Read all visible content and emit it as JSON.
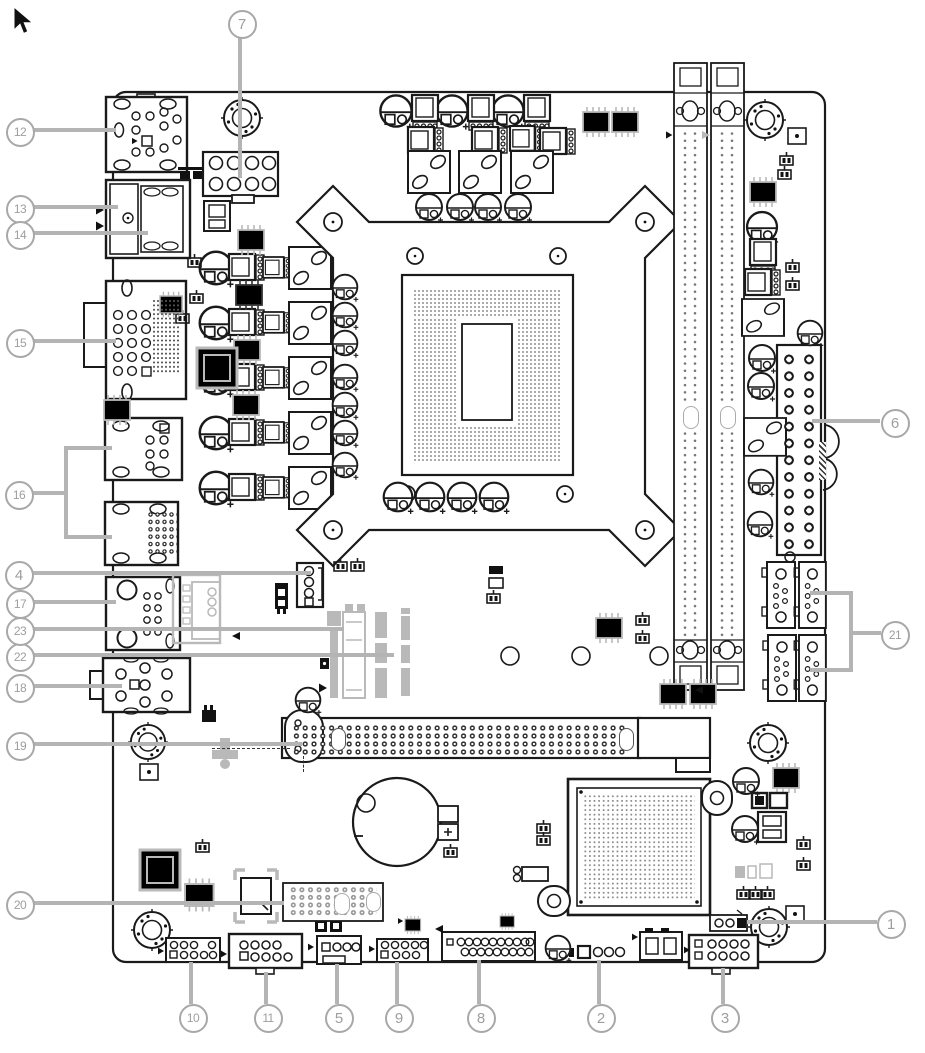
{
  "figure": {
    "kind": "motherboard-layout-diagram",
    "palette": {
      "ink": "#1a1a1a",
      "gray_parts": "#b9b9b9",
      "leader_line": "#b4b4b4",
      "callout": "#a8a8a8"
    }
  },
  "callouts": [
    {
      "label": "1",
      "target": "jumper",
      "cx": 889,
      "cy": 922,
      "lines": [
        [
          747,
          920,
          130,
          4
        ]
      ]
    },
    {
      "label": "2",
      "target": "4-pin-header",
      "cx": 599,
      "cy": 1016,
      "lines": [
        [
          597,
          960,
          4,
          44
        ]
      ]
    },
    {
      "label": "3",
      "target": "2x5-header",
      "cx": 723,
      "cy": 1016,
      "lines": [
        [
          721,
          968,
          4,
          36
        ]
      ]
    },
    {
      "label": "4",
      "target": "4-pin-connector",
      "cx": 17,
      "cy": 573,
      "lines": [
        [
          29,
          571,
          282,
          4
        ]
      ]
    },
    {
      "label": "5",
      "target": "fan-connector",
      "cx": 337,
      "cy": 1016,
      "lines": [
        [
          335,
          964,
          4,
          40
        ]
      ]
    },
    {
      "label": "6",
      "target": "atx-power-connector",
      "cx": 893,
      "cy": 421,
      "lines": [
        [
          812,
          419,
          68,
          4
        ]
      ]
    },
    {
      "label": "7",
      "target": "cpu-power-connector",
      "cx": 240,
      "cy": 22,
      "lines": [
        [
          238,
          34,
          4,
          144
        ]
      ]
    },
    {
      "label": "8",
      "target": "front-panel-header",
      "cx": 479,
      "cy": 1016,
      "lines": [
        [
          477,
          960,
          4,
          44
        ]
      ]
    },
    {
      "label": "9",
      "target": "2x5-header",
      "cx": 397,
      "cy": 1016,
      "lines": [
        [
          395,
          962,
          4,
          42
        ]
      ]
    },
    {
      "label": "10",
      "target": "2x5-header",
      "cx": 191,
      "cy": 1016,
      "lines": [
        [
          189,
          962,
          4,
          42
        ]
      ]
    },
    {
      "label": "11",
      "target": "usb-header",
      "cx": 266,
      "cy": 1016,
      "lines": [
        [
          264,
          972,
          4,
          32
        ]
      ]
    },
    {
      "label": "12",
      "target": "usb-ports",
      "cx": 18,
      "cy": 130,
      "lines": [
        [
          30,
          128,
          86,
          4
        ]
      ]
    },
    {
      "label": "13",
      "target": "display-port",
      "cx": 18,
      "cy": 207,
      "lines": [
        [
          30,
          205,
          88,
          4
        ]
      ]
    },
    {
      "label": "14",
      "target": "hdmi-port",
      "cx": 18,
      "cy": 233,
      "lines": [
        [
          30,
          231,
          118,
          4
        ]
      ]
    },
    {
      "label": "15",
      "target": "vga-port",
      "cx": 18,
      "cy": 341,
      "lines": [
        [
          30,
          339,
          86,
          4
        ]
      ]
    },
    {
      "label": "16",
      "target": "usb-lan-ports",
      "cx": 17,
      "cy": 493,
      "lines": [
        [
          29,
          491,
          37,
          4
        ],
        [
          64,
          446,
          4,
          93
        ],
        [
          66,
          446,
          46,
          4
        ],
        [
          66,
          535,
          46,
          4
        ]
      ]
    },
    {
      "label": "17",
      "target": "usb-ports",
      "cx": 18,
      "cy": 602,
      "lines": [
        [
          30,
          600,
          86,
          4
        ]
      ]
    },
    {
      "label": "18",
      "target": "audio-jacks",
      "cx": 18,
      "cy": 686,
      "lines": [
        [
          30,
          684,
          92,
          4
        ]
      ]
    },
    {
      "label": "19",
      "target": "expansion-slot",
      "cx": 18,
      "cy": 744,
      "lines": [
        [
          30,
          742,
          272,
          4
        ]
      ]
    },
    {
      "label": "20",
      "target": "pin-header-block",
      "cx": 18,
      "cy": 903,
      "lines": [
        [
          30,
          901,
          254,
          4
        ]
      ]
    },
    {
      "label": "21",
      "target": "sata-connectors",
      "cx": 893,
      "cy": 633,
      "lines": [
        [
          849,
          591,
          4,
          81
        ],
        [
          810,
          591,
          39,
          4
        ],
        [
          810,
          668,
          39,
          4
        ],
        [
          853,
          631,
          28,
          4
        ]
      ]
    },
    {
      "label": "22",
      "target": "m2-slot",
      "cx": 18,
      "cy": 655,
      "lines": [
        [
          30,
          653,
          364,
          4
        ]
      ]
    },
    {
      "label": "23",
      "target": "m2-slot",
      "cx": 18,
      "cy": 629,
      "lines": [
        [
          30,
          627,
          314,
          4
        ]
      ]
    }
  ]
}
